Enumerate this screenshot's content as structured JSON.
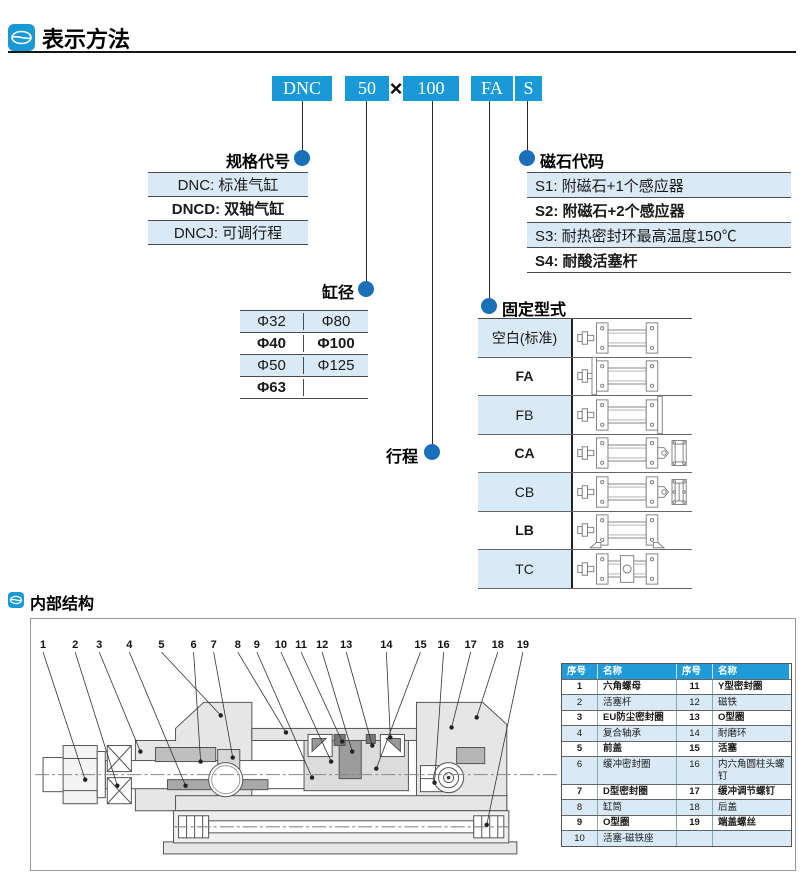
{
  "header": {
    "title": "表示方法"
  },
  "internal_header": {
    "title": "内部结构"
  },
  "model_code": {
    "segments": [
      "DNC",
      "50",
      "100",
      "FA",
      "S"
    ],
    "multiply_sign": "×"
  },
  "spec": {
    "title": "规格代号",
    "rows": [
      "DNC: 标准气缸",
      "DNCD: 双轴气缸",
      "DNCJ: 可调行程"
    ]
  },
  "magnet": {
    "title": "磁石代码",
    "rows": [
      "S1: 附磁石+1个感应器",
      "S2: 附磁石+2个感应器",
      "S3: 耐热密封环最高温度150℃",
      "S4: 耐酸活塞杆"
    ]
  },
  "bore": {
    "title": "缸径",
    "rows": [
      [
        "Φ32",
        "Φ80"
      ],
      [
        "Φ40",
        "Φ100"
      ],
      [
        "Φ50",
        "Φ125"
      ],
      [
        "Φ63",
        ""
      ]
    ]
  },
  "stroke": {
    "title": "行程"
  },
  "mounting": {
    "title": "固定型式",
    "rows": [
      {
        "label": "空白(标准)",
        "variant": "blank"
      },
      {
        "label": "FA",
        "variant": "fa"
      },
      {
        "label": "FB",
        "variant": "fb"
      },
      {
        "label": "CA",
        "variant": "ca"
      },
      {
        "label": "CB",
        "variant": "cb"
      },
      {
        "label": "LB",
        "variant": "lb"
      },
      {
        "label": "TC",
        "variant": "tc"
      }
    ]
  },
  "internal": {
    "callouts": [
      "1",
      "2",
      "3",
      "4",
      "5",
      "6",
      "7",
      "8",
      "9",
      "10",
      "11",
      "12",
      "13",
      "14",
      "15",
      "16",
      "17",
      "18",
      "19"
    ],
    "parts_table": {
      "headers": [
        "序号",
        "名称",
        "序号",
        "名称"
      ],
      "rows": [
        [
          "1",
          "六角螺母",
          "11",
          "Y型密封圈"
        ],
        [
          "2",
          "活塞杆",
          "12",
          "磁铁"
        ],
        [
          "3",
          "EU防尘密封圈",
          "13",
          "O型圈"
        ],
        [
          "4",
          "复合轴承",
          "14",
          "耐磨环"
        ],
        [
          "5",
          "前盖",
          "15",
          "活塞"
        ],
        [
          "6",
          "缓冲密封圈",
          "16",
          "内六角圆柱头螺钉"
        ],
        [
          "7",
          "D型密封圈",
          "17",
          "缓冲调节螺钉"
        ],
        [
          "8",
          "缸筒",
          "18",
          "后盖"
        ],
        [
          "9",
          "O型圈",
          "19",
          "端盖螺丝"
        ],
        [
          "10",
          "活塞-磁铁座",
          "",
          ""
        ]
      ]
    }
  },
  "colors": {
    "box_blue": "#1999D6",
    "dot_blue": "#1A70B8",
    "row_blue": "#D9EAF6",
    "table_header_blue": "#1F9CD8"
  }
}
